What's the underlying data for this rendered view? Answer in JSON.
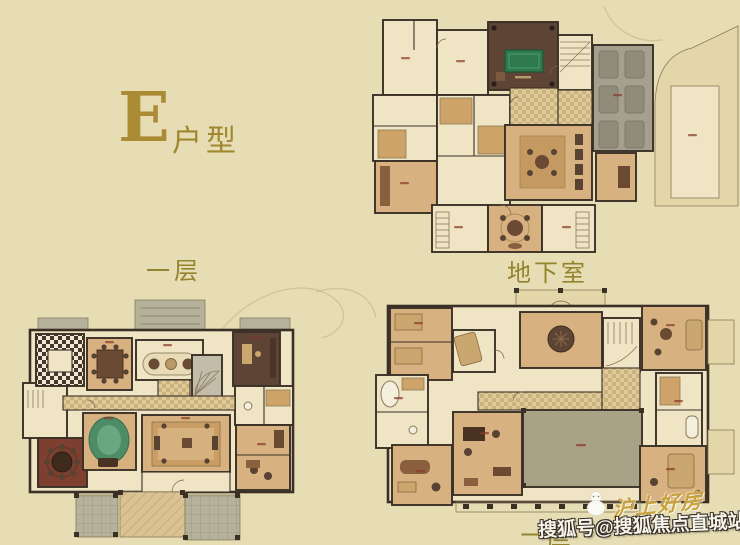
{
  "page": {
    "description": "Real-estate flyer with three villa floor plans for unit E",
    "background": "#e7ddb4"
  },
  "labels": {
    "unit_letter": "E",
    "unit_suffix": "户型",
    "first_floor": "一层",
    "basement": "地下室",
    "second_floor": "二层"
  },
  "watermark": {
    "account": "搜狐号@搜狐焦点直城站",
    "brand": "沪上好房",
    "logo_icon": "sohu-white-mascot"
  },
  "floorplans": [
    {
      "id": "basement",
      "label": "地下室",
      "features": [
        "billiard-room",
        "garage",
        "home-theater",
        "sunken-courtyard",
        "stairs"
      ]
    },
    {
      "id": "first-floor",
      "label": "一层",
      "features": [
        "kitchen",
        "dining-room",
        "living-room",
        "study",
        "round-dining-room",
        "terraces"
      ]
    },
    {
      "id": "second-floor",
      "label": "二层",
      "features": [
        "bedrooms",
        "bathrooms",
        "family-room",
        "void-over-living-room",
        "balconies"
      ]
    }
  ],
  "palette": {
    "bg": "#e7ddb4",
    "wall": "#3a3026",
    "cream": "#efe5c4",
    "cream2": "#e3d7a9",
    "tan": "#d7b280",
    "tan-deep": "#cda369",
    "brown": "#5d4434",
    "maroon": "#7d4030",
    "green": "#4c8c66",
    "billiard": "#2e7a4e",
    "gray": "#a5a08e",
    "terrace": "#b5b29b",
    "olive": "#a9a287",
    "gold": "#ab8c35",
    "label": "#93832f",
    "white": "#f7f3e8",
    "red-label": "#8a3a2a",
    "furn": "#6b4a33"
  }
}
